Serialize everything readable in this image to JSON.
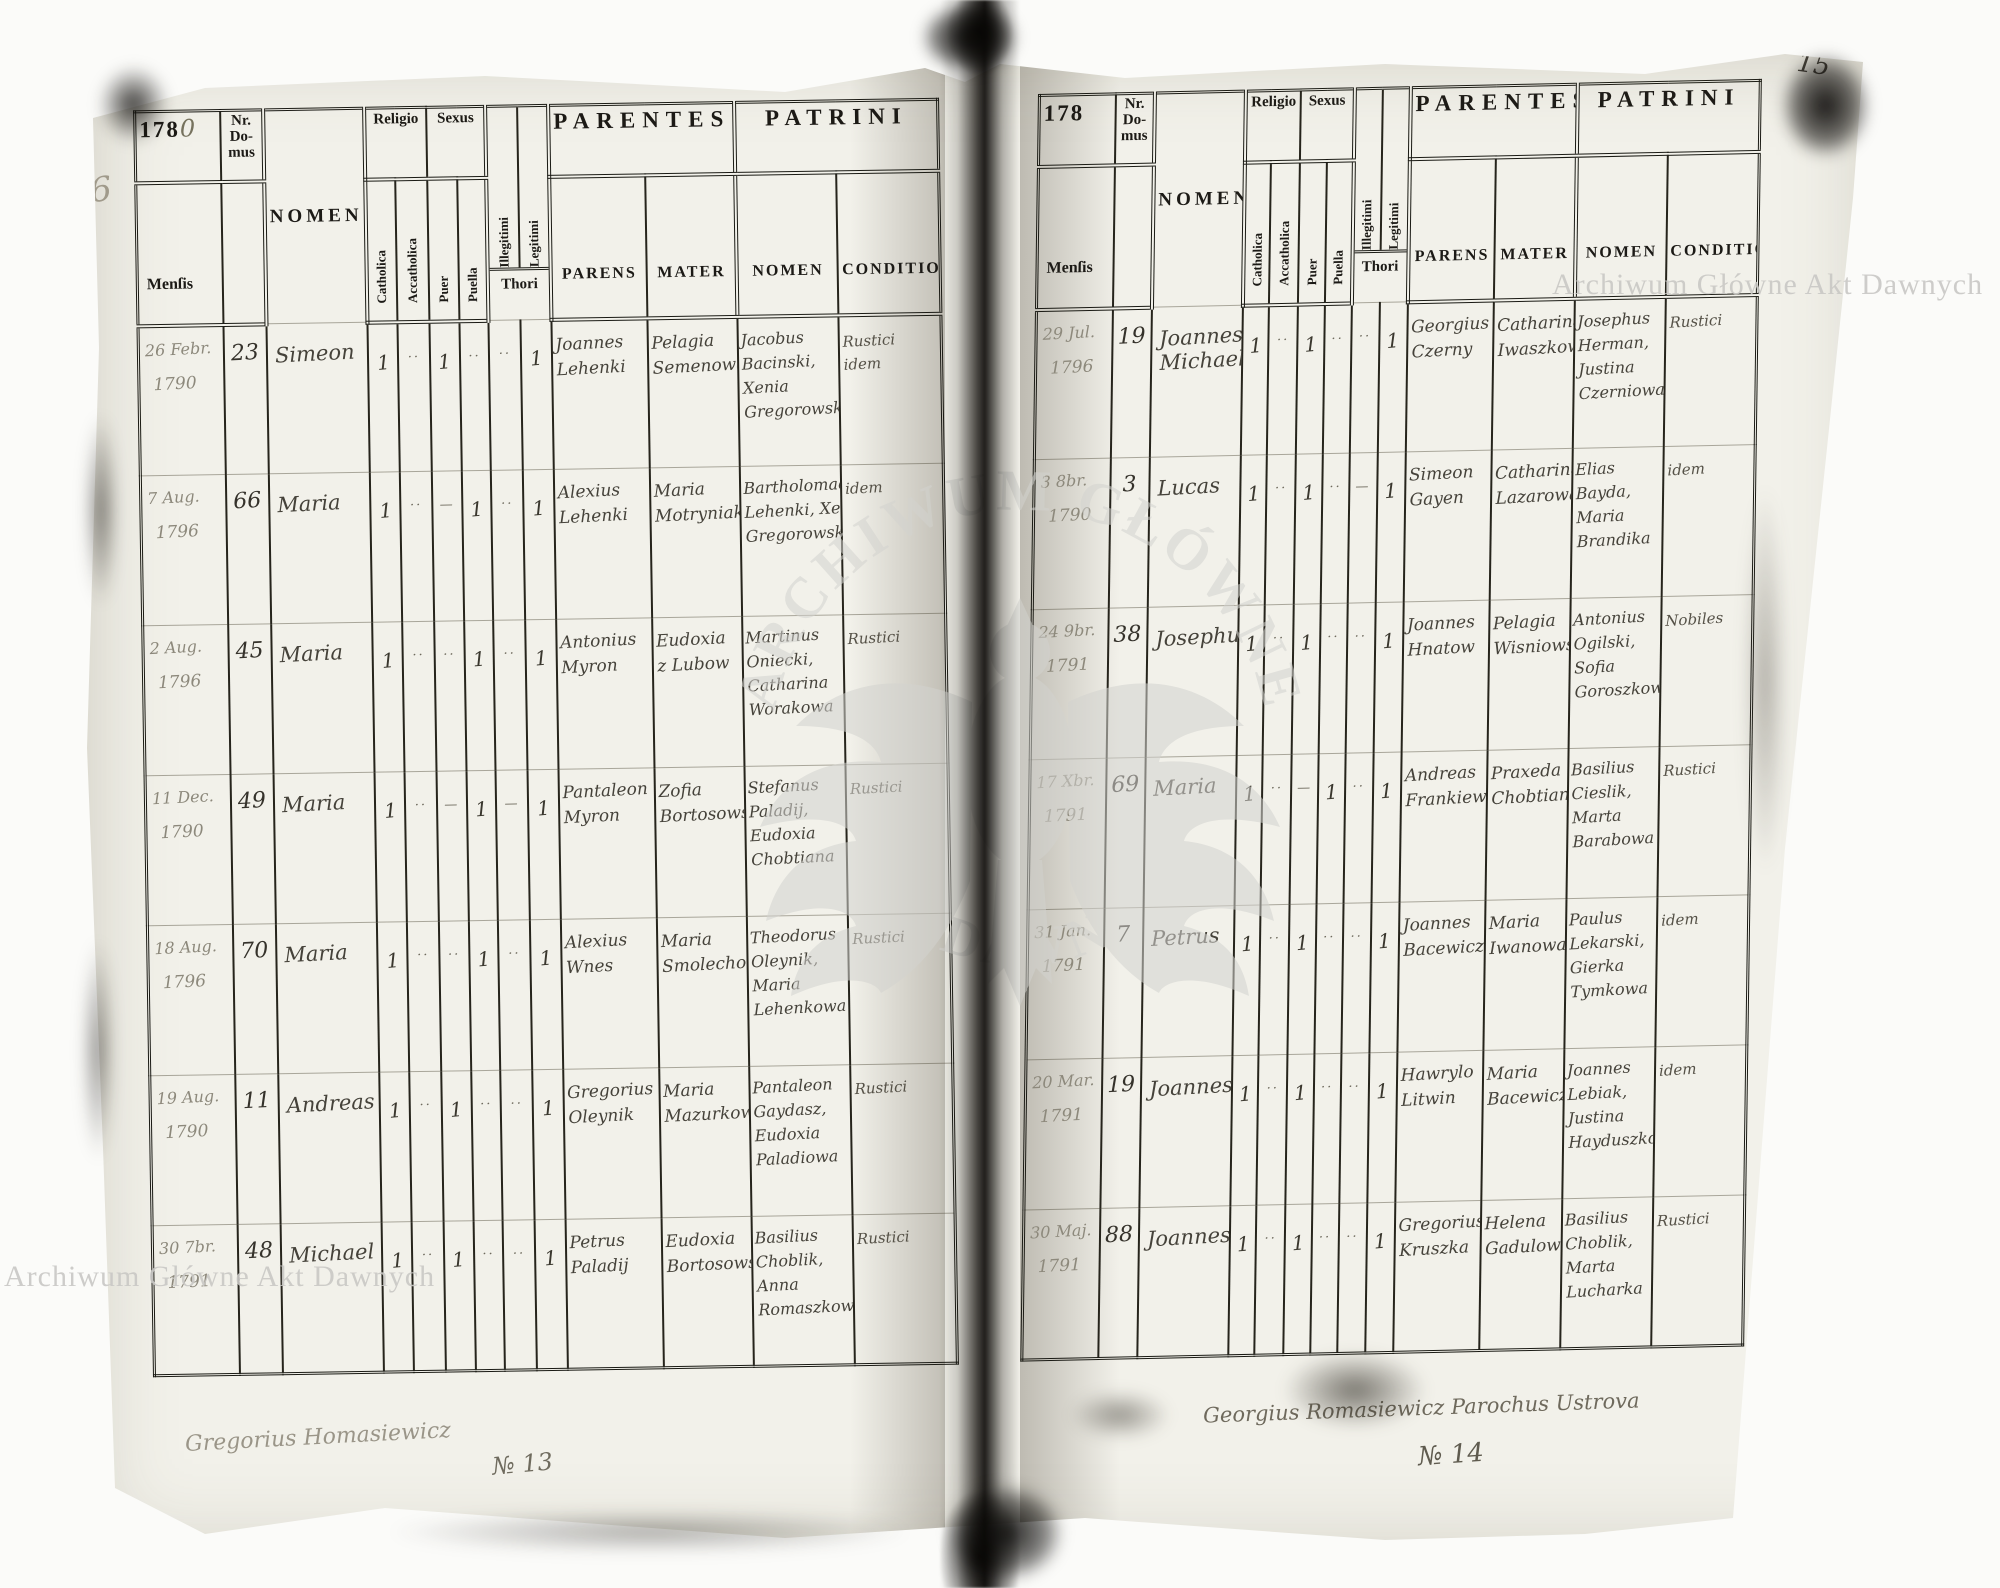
{
  "watermarks": {
    "corner_top_right": "Archiwum Główne Akt Dawnych",
    "corner_bottom_left": "Archiwum Główne Akt Dawnych",
    "ring_top": "ARCHIWUM GŁÓWNE",
    "ring_bottom": "AKT DAWNYCH",
    "color": "#cccccb"
  },
  "marginalia": {
    "folio_top_left": "141",
    "folio_top_right": "15",
    "pencil_left_margin": "6",
    "register_no_left": "№ 13",
    "register_no_right": "№ 14",
    "signature_left": "Gregorius Homasiewicz",
    "signature_right": "Georgius Romasiewicz Parochus Ustrova"
  },
  "headers": {
    "year_prefix": "178",
    "mensis": "Menſis",
    "nr_domus": "Nr. Do- mus",
    "nomen": "NOMEN",
    "religio": "Religio",
    "sexus": "Sexus",
    "catholica": "Catholica",
    "accatholica": "Accatholica",
    "puer": "Puer",
    "puella": "Puella",
    "illegitimi": "Illegitimi",
    "legitimi": "Legitimi",
    "thori": "Thori",
    "parentes": "PARENTES",
    "patrini": "PATRINI",
    "parens": "PARENS",
    "mater": "MATER",
    "patrini_nomen": "NOMEN",
    "conditio": "CONDITIO"
  },
  "left_page": {
    "year_hand": "0",
    "rows": [
      {
        "mensis": "26 Febr.",
        "year": "1790",
        "nr": "23",
        "nomen": "Simeon",
        "cath": "1",
        "acc": "··",
        "puer": "1",
        "puella": "··",
        "ill": "··",
        "leg": "1",
        "parens": "Joannes Lehenki",
        "mater": "Pelagia Semenowa",
        "patrini": "Jacobus Bacinski, Xenia Gregorowska",
        "conditio": "Rustici idem"
      },
      {
        "mensis": "7 Aug.",
        "year": "1796",
        "nr": "66",
        "nomen": "Maria",
        "cath": "1",
        "acc": "··",
        "puer": "—",
        "puella": "1",
        "ill": "··",
        "leg": "1",
        "parens": "Alexius Lehenki",
        "mater": "Maria Motryniak",
        "patrini": "Bartholomaeus Lehenki, Xenia Gregorowska",
        "conditio": "idem"
      },
      {
        "mensis": "2 Aug.",
        "year": "1796",
        "nr": "45",
        "nomen": "Maria",
        "cath": "1",
        "acc": "··",
        "puer": "··",
        "puella": "1",
        "ill": "··",
        "leg": "1",
        "parens": "Antonius Myron",
        "mater": "Eudoxia z Lubow",
        "patrini": "Martinus Oniecki, Catharina Worakowa",
        "conditio": "Rustici"
      },
      {
        "mensis": "11 Dec.",
        "year": "1790",
        "nr": "49",
        "nomen": "Maria",
        "cath": "1",
        "acc": "··",
        "puer": "—",
        "puella": "1",
        "ill": "—",
        "leg": "1",
        "parens": "Pantaleon Myron",
        "mater": "Zofia Bortosowska",
        "patrini": "Stefanus Paladij, Eudoxia Chobtiana",
        "conditio": "Rustici"
      },
      {
        "mensis": "18 Aug.",
        "year": "1796",
        "nr": "70",
        "nomen": "Maria",
        "cath": "1",
        "acc": "··",
        "puer": "··",
        "puella": "1",
        "ill": "··",
        "leg": "1",
        "parens": "Alexius Wnes",
        "mater": "Maria Smolechowa",
        "patrini": "Theodorus Oleynik, Maria Lehenkowa",
        "conditio": "Rustici"
      },
      {
        "mensis": "19 Aug.",
        "year": "1790",
        "nr": "11",
        "nomen": "Andreas",
        "cath": "1",
        "acc": "··",
        "puer": "1",
        "puella": "··",
        "ill": "··",
        "leg": "1",
        "parens": "Gregorius Oleynik",
        "mater": "Maria Mazurkowa",
        "patrini": "Pantaleon Gaydasz, Eudoxia Paladiowa",
        "conditio": "Rustici"
      },
      {
        "mensis": "30 7br.",
        "year": "1791",
        "nr": "48",
        "nomen": "Michael",
        "cath": "1",
        "acc": "··",
        "puer": "1",
        "puella": "··",
        "ill": "··",
        "leg": "1",
        "parens": "Petrus Paladij",
        "mater": "Eudoxia Bortosowska",
        "patrini": "Basilius Choblik, Anna Romaszkowa",
        "conditio": "Rustici"
      }
    ]
  },
  "right_page": {
    "year_hand": "",
    "rows": [
      {
        "mensis": "29 Jul.",
        "year": "1796",
        "nr": "19",
        "nomen": "Joannes Michael",
        "cath": "1",
        "acc": "··",
        "puer": "1",
        "puella": "··",
        "ill": "··",
        "leg": "1",
        "parens": "Georgius Czerny",
        "mater": "Catharina Iwaszkowa",
        "patrini": "Josephus Herman, Justina Czerniowa",
        "conditio": "Rustici"
      },
      {
        "mensis": "3 8br.",
        "year": "1790",
        "nr": "3",
        "nomen": "Lucas",
        "cath": "1",
        "acc": "··",
        "puer": "1",
        "puella": "··",
        "ill": "—",
        "leg": "1",
        "parens": "Simeon Gayen",
        "mater": "Catharina Lazarowa",
        "patrini": "Elias Bayda, Maria Brandika",
        "conditio": "idem"
      },
      {
        "mensis": "24 9br.",
        "year": "1791",
        "nr": "38",
        "nomen": "Josephus",
        "cath": "1",
        "acc": "··",
        "puer": "1",
        "puella": "··",
        "ill": "··",
        "leg": "1",
        "parens": "Joannes Hnatow",
        "mater": "Pelagia Wisniowska",
        "patrini": "Antonius Ogilski, Sofia Goroszkowa",
        "conditio": "Nobiles"
      },
      {
        "mensis": "17 Xbr.",
        "year": "1791",
        "nr": "69",
        "nomen": "Maria",
        "cath": "1",
        "acc": "··",
        "puer": "—",
        "puella": "1",
        "ill": "··",
        "leg": "1",
        "parens": "Andreas Frankiewicz",
        "mater": "Praxeda Chobtiana",
        "patrini": "Basilius Cieslik, Marta Barabowa",
        "conditio": "Rustici"
      },
      {
        "mensis": "31 Jan.",
        "year": "1791",
        "nr": "7",
        "nomen": "Petrus",
        "cath": "1",
        "acc": "··",
        "puer": "1",
        "puella": "··",
        "ill": "··",
        "leg": "1",
        "parens": "Joannes Bacewicz",
        "mater": "Maria Iwanowa",
        "patrini": "Paulus Lekarski, Gierka Tymkowa",
        "conditio": "idem"
      },
      {
        "mensis": "20 Mar.",
        "year": "1791",
        "nr": "19",
        "nomen": "Joannes",
        "cath": "1",
        "acc": "··",
        "puer": "1",
        "puella": "··",
        "ill": "··",
        "leg": "1",
        "parens": "Hawrylo Litwin",
        "mater": "Maria Bacewiczowa",
        "patrini": "Joannes Lebiak, Justina Hayduszkowa",
        "conditio": "idem"
      },
      {
        "mensis": "30 Maj.",
        "year": "1791",
        "nr": "88",
        "nomen": "Joannes",
        "cath": "1",
        "acc": "··",
        "puer": "1",
        "puella": "··",
        "ill": "··",
        "leg": "1",
        "parens": "Gregorius Kruszka",
        "mater": "Helena Gadulowa",
        "patrini": "Basilius Choblik, Marta Lucharka",
        "conditio": "Rustici"
      }
    ]
  }
}
